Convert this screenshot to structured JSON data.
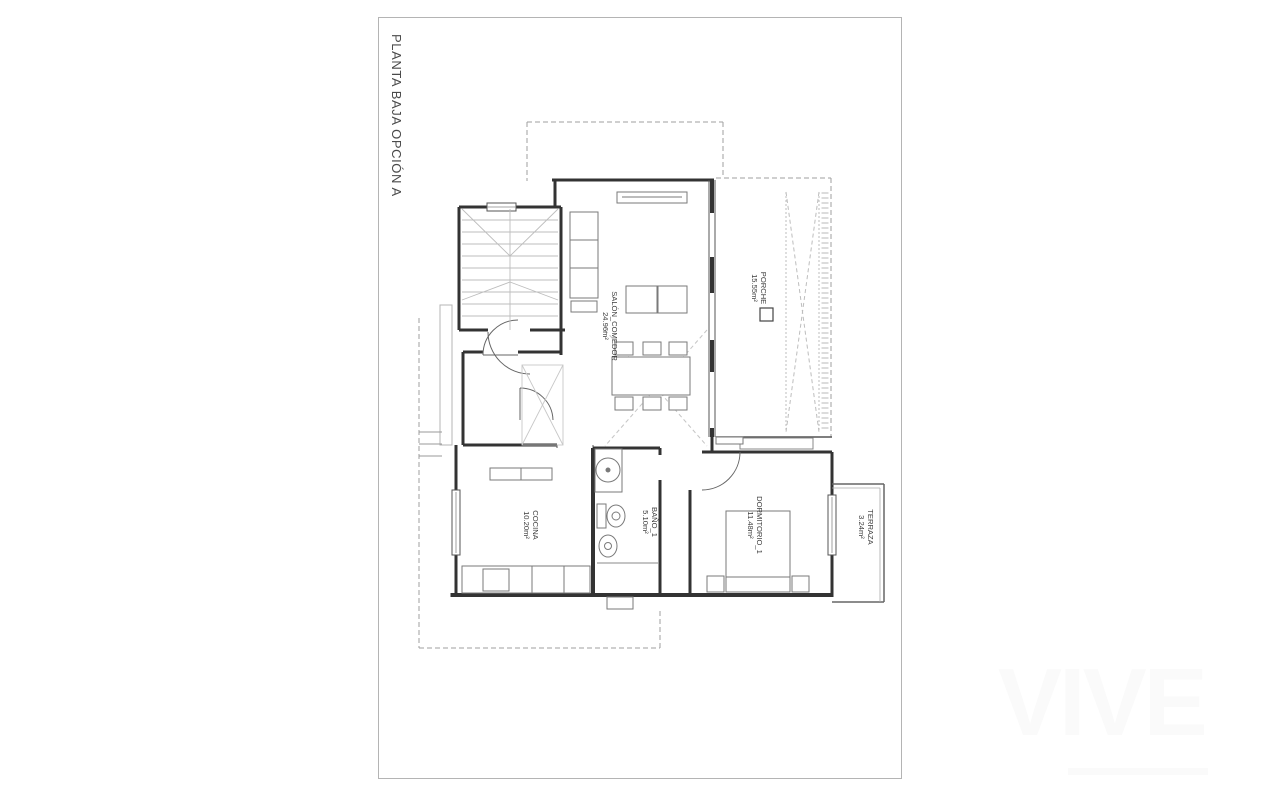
{
  "sheet": {
    "title": "PLANTA BAJA OPCIÓN A"
  },
  "rooms": [
    {
      "id": "salon",
      "name": "SALÓN_COMEDOR",
      "area": "24.96m²"
    },
    {
      "id": "porche",
      "name": "PORCHE",
      "area": "15.55m²"
    },
    {
      "id": "cocina",
      "name": "COCINA",
      "area": "10.20m²"
    },
    {
      "id": "bano",
      "name": "BAÑO_1",
      "area": "5.10m²"
    },
    {
      "id": "dormitorio",
      "name": "DORMITORIO_1",
      "area": "11.48m²"
    },
    {
      "id": "terraza",
      "name": "TERRAZA",
      "area": "3.24m²"
    }
  ],
  "watermark": {
    "text": "VIVE"
  },
  "colors": {
    "wall_ink": "#333333",
    "thin_line": "#666666",
    "furniture_line": "#7a7a7a",
    "light_line": "#bdbdbd",
    "dashed_line": "#9f9f9f",
    "sheet_border": "#b4b4b4",
    "label_ink": "#3d3d3d",
    "watermark": "#fafafa"
  }
}
